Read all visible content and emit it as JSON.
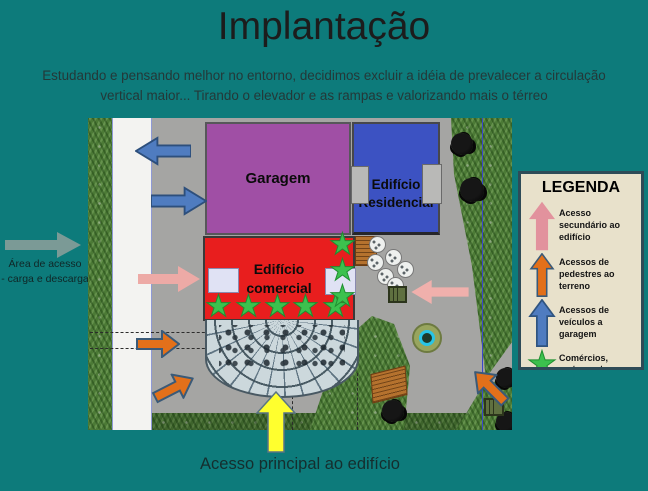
{
  "slide": {
    "title": "Implantação",
    "subtitle": "Estudando e pensando melhor no entorno, decidimos excluir a idéia de prevalecer a circulação vertical maior... Tirando o elevador e as rampas e valorizando mais o térreo"
  },
  "annotations": {
    "cargo_line1": "Área de acesso",
    "cargo_line2": "- carga e descarga",
    "main_access": "Acesso principal ao edifício"
  },
  "site_plan": {
    "garage_label": "Garagem",
    "residential_label": "Edifício Residencial",
    "commercial_label": "Edifício comercial"
  },
  "legend": {
    "title": "LEGENDA",
    "items": [
      {
        "icon": "up-arrow",
        "color": "#e2929d",
        "label": "Acesso secundário ao edifício"
      },
      {
        "icon": "up-arrow",
        "color": "#e2701a",
        "label": "Acessos de pedestres ao terreno"
      },
      {
        "icon": "up-arrow",
        "color": "#4f7cc0",
        "label": "Acessos de veículos a garagem"
      },
      {
        "icon": "star",
        "color": "#3cc14e",
        "label": "Comércios, restaurantes..."
      }
    ]
  },
  "icons": {
    "star": "★"
  },
  "colors": {
    "background": "#0d7b7b",
    "garage": "#a04fa5",
    "residential": "#3c52c2",
    "commercial": "#e81e1e",
    "star_green": "#3cc14e",
    "arrow_pink": "#e2929d",
    "arrow_orange": "#e2701a",
    "arrow_blue": "#4f7cc0",
    "arrow_gray": "#7b9a96",
    "arrow_yellow": "#ffff2e",
    "legend_background": "#e8e1cb"
  }
}
